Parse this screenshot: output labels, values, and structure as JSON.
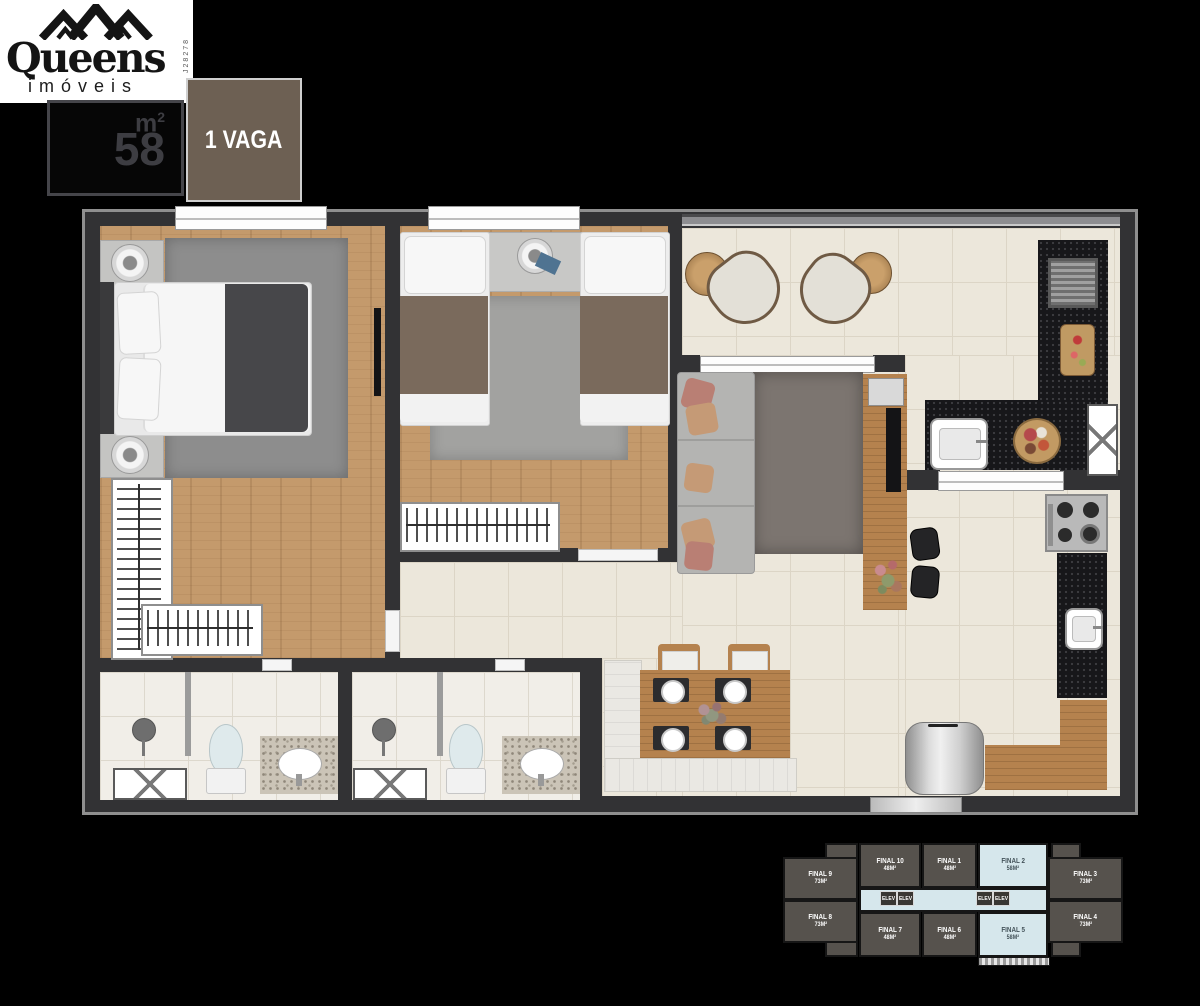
{
  "header": {
    "logo": {
      "brand": "Queens",
      "subtitle": "imóveis",
      "registration": "J28278"
    },
    "area_badge": {
      "value": "58",
      "unit": "m",
      "sup": "2"
    },
    "parking_badge": {
      "label": "1 VAGA"
    }
  },
  "colors": {
    "background": "#000000",
    "badge_brown": "#6d6053",
    "wall": "#323234",
    "wood_floor": "#c49a6c",
    "tile_floor": "#ece7db",
    "counter_black": "#17171a",
    "keyplan_unit_gray": "#56524d",
    "keyplan_highlight_blue": "#d6e7ec"
  },
  "key_plan": {
    "elevator_label": "ELEV",
    "units": [
      {
        "label": "FINAL 9",
        "area": "73M²",
        "highlighted": false
      },
      {
        "label": "FINAL 10",
        "area": "48M²",
        "highlighted": false
      },
      {
        "label": "FINAL 1",
        "area": "48M²",
        "highlighted": false
      },
      {
        "label": "FINAL 2",
        "area": "58M²",
        "highlighted": true
      },
      {
        "label": "FINAL 3",
        "area": "73M²",
        "highlighted": false
      },
      {
        "label": "FINAL 8",
        "area": "73M²",
        "highlighted": false
      },
      {
        "label": "FINAL 7",
        "area": "48M²",
        "highlighted": false
      },
      {
        "label": "FINAL 6",
        "area": "48M²",
        "highlighted": false
      },
      {
        "label": "FINAL 5",
        "area": "58M²",
        "highlighted": true
      },
      {
        "label": "FINAL 4",
        "area": "73M²",
        "highlighted": false
      }
    ]
  }
}
